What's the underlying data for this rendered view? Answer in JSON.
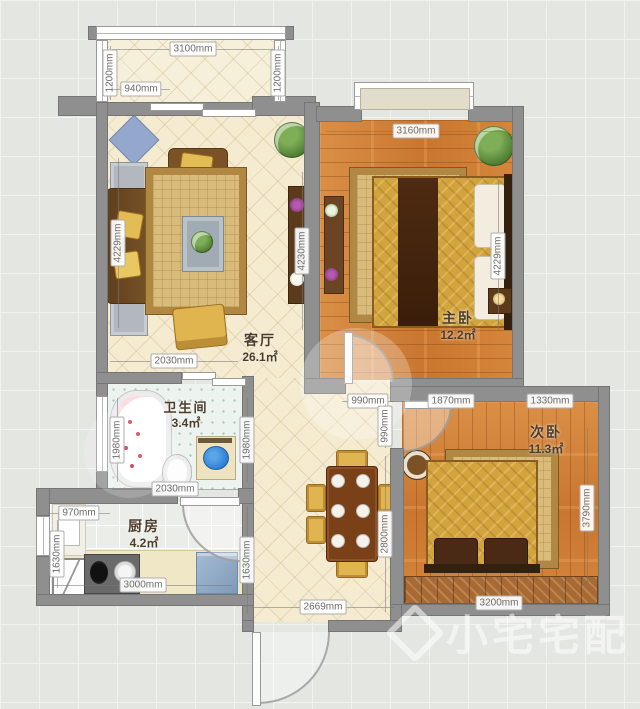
{
  "watermark": {
    "text": "小宅宅配",
    "logo": "diamond-logo"
  },
  "rooms": {
    "living": {
      "name": "客厅",
      "area": "26.1㎡"
    },
    "master": {
      "name": "主卧",
      "area": "12.2㎡"
    },
    "second": {
      "name": "次卧",
      "area": "11.3㎡"
    },
    "bathroom": {
      "name": "卫生间",
      "area": "3.4㎡"
    },
    "kitchen": {
      "name": "厨房",
      "area": "4.2㎡"
    }
  },
  "dimensions": {
    "balcony_width": "3100mm",
    "balcony_left": "1200mm",
    "balcony_right": "1200mm",
    "balcony_opening": "940mm",
    "living_left": "4229mm",
    "living_right": "4230mm",
    "living_bottom": "2030mm",
    "master_top": "3160mm",
    "master_right": "4229mm",
    "master_door": "990mm",
    "second_top_left": "1870mm",
    "second_top_right": "1330mm",
    "second_right": "3790mm",
    "second_bottom": "3200mm",
    "second_door": "990mm",
    "bath_left": "1980mm",
    "bath_right": "1980mm",
    "bath_bottom": "2030mm",
    "kitchen_top": "970mm",
    "kitchen_left": "1630mm",
    "kitchen_bottom": "3000mm",
    "hall_right_lower": "2800mm",
    "hall_left_lower": "1630mm",
    "hall_bottom": "2669mm"
  },
  "colors": {
    "wall": "#8f8f8f",
    "floor_cream": "#f4ebd1",
    "floor_wood": "#d0823c",
    "accent_gold": "#d2a43e",
    "grid_bg": "#e4e6e2"
  }
}
